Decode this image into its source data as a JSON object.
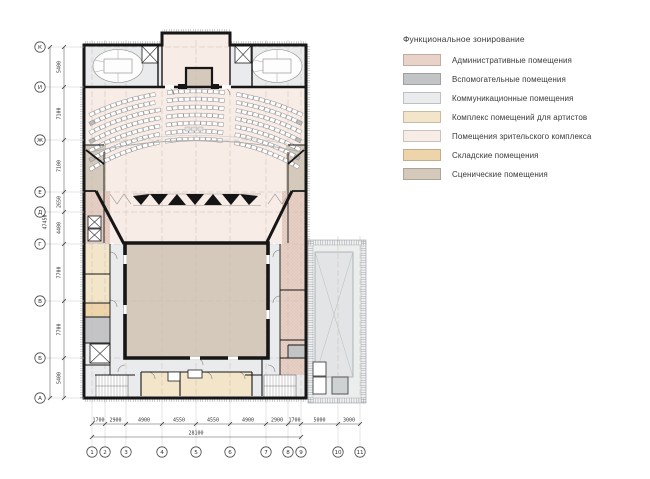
{
  "legend": {
    "title": "Функциональное зонирование",
    "items": [
      {
        "id": "admin",
        "label": "Административные помещения",
        "color": "#e9d3c9"
      },
      {
        "id": "aux",
        "label": "Вспомогательные помещения",
        "color": "#c3c4c6"
      },
      {
        "id": "comm",
        "label": "Коммуникационные помещения",
        "color": "#e9ebec"
      },
      {
        "id": "artists",
        "label": "Комплекс помещений для артистов",
        "color": "#f2e5c9"
      },
      {
        "id": "audience",
        "label": "Помещения зрительского комплекса",
        "color": "#f8ece6"
      },
      {
        "id": "storage",
        "label": "Складские помещения",
        "color": "#eed4aa"
      },
      {
        "id": "stage",
        "label": "Сценические помещения",
        "color": "#d4c9ba"
      }
    ]
  },
  "plan": {
    "vertical_axes": {
      "labels": [
        "К",
        "И",
        "Ж",
        "Е",
        "Д",
        "Г",
        "В",
        "Б",
        "А"
      ],
      "dims": [
        "5400",
        "7100",
        "7100",
        "2650",
        "4400",
        "7700",
        "7700",
        "5400"
      ],
      "total": "47450"
    },
    "horizontal_axes": {
      "labels": [
        "1",
        "2",
        "3",
        "4",
        "5",
        "6",
        "7",
        "8",
        "9",
        "10",
        "11"
      ],
      "dims": [
        "1700",
        "2900",
        "4900",
        "4550",
        "4550",
        "4900",
        "2900",
        "1700",
        "5000",
        "3000"
      ],
      "total": "28100"
    }
  }
}
